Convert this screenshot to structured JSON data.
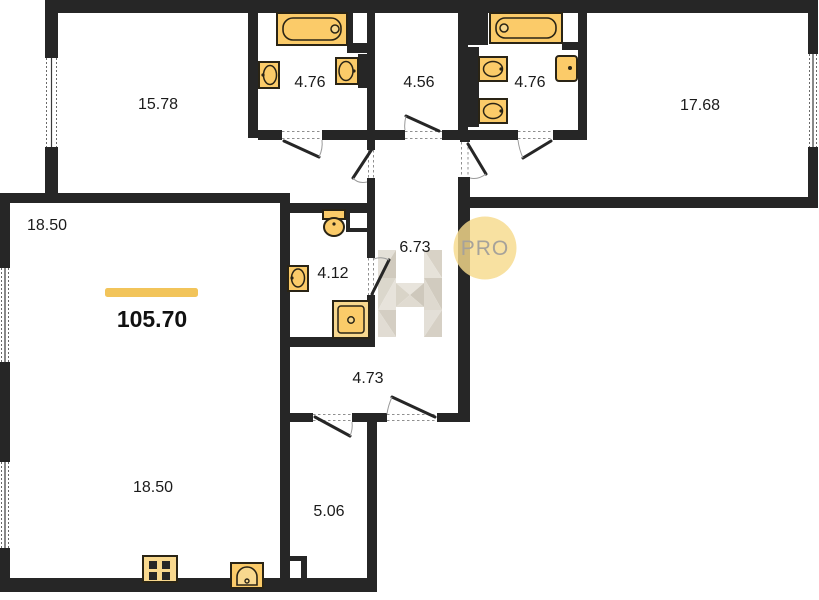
{
  "total": {
    "value": "105.70"
  },
  "watermark": {
    "badge_text": "PRO"
  },
  "rooms": [
    {
      "name": "room-top-left",
      "area": "15.78"
    },
    {
      "name": "bathroom-1",
      "area": "4.76"
    },
    {
      "name": "hallway-top",
      "area": "4.56"
    },
    {
      "name": "bathroom-2",
      "area": "4.76"
    },
    {
      "name": "room-top-right",
      "area": "17.68"
    },
    {
      "name": "living-room",
      "area": "18.50"
    },
    {
      "name": "bathroom-3",
      "area": "4.12"
    },
    {
      "name": "hallway-center",
      "area": "6.73"
    },
    {
      "name": "corridor",
      "area": "4.73"
    },
    {
      "name": "kitchen-living",
      "area": "18.50"
    },
    {
      "name": "pantry",
      "area": "5.06"
    }
  ],
  "colors": {
    "wall": "#262626",
    "fixture_fill": "#FBCB69",
    "fixture_fill_light": "#F8D88E",
    "accent_bar": "#F2C45A",
    "watermark_circle": "#F7DA8C",
    "watermark_text": "#A6A29A"
  }
}
